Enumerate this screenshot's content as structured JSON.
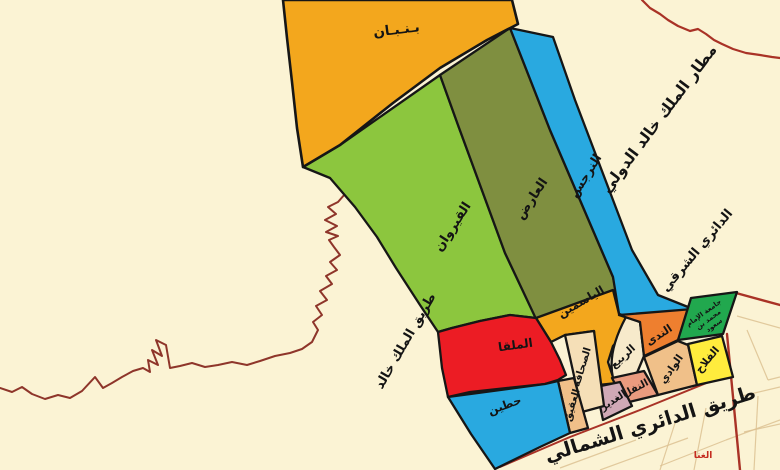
{
  "colors": {
    "background": "#FBF3D4",
    "orange": "#F3A71D",
    "light_green": "#8CC63E",
    "olive": "#7F8F40",
    "blue": "#29A9E0",
    "red": "#EC1C24",
    "cream": "#F5DFB7",
    "cream_light": "#F7EACB",
    "tan": "#F0C089",
    "mauve": "#D0A9B6",
    "salmon": "#EA9B7F",
    "orange_deep": "#EE7F2F",
    "yellow": "#FFEC3D",
    "green": "#21A84E",
    "road_red": "#A93226",
    "wadi_line": "#8E352A",
    "parcel": "#DCC192",
    "label": "#141414",
    "red_text": "#C42B1F"
  },
  "districts": {
    "banban": {
      "label": "بـنـبـان"
    },
    "qairawan": {
      "label": "القيروان"
    },
    "arid": {
      "label": "العارض"
    },
    "narjis": {
      "label": "النرجس"
    },
    "yasmin": {
      "label": "الياسمين"
    },
    "malqa": {
      "label": "الملقا"
    },
    "hittin": {
      "label": "حطين"
    },
    "sahafa": {
      "label": "الصحافة"
    },
    "rabi": {
      "label": "الربيع"
    },
    "aqiq": {
      "label": "العقيق"
    },
    "ghadir": {
      "label": "الغدير"
    },
    "nafal": {
      "label": "النفل"
    },
    "wadi": {
      "label": "الوادي"
    },
    "nada": {
      "label": "الندى"
    },
    "falah": {
      "label": "الفلاح"
    },
    "ghina": {
      "label": "الغنا"
    }
  },
  "landmarks": {
    "university": {
      "line1": "جامعة الإمام",
      "line2": "محمد بن",
      "line3": "سعود"
    },
    "airport": {
      "label": "مطار الملك خالد الدولي"
    }
  },
  "roads": {
    "east_ring": {
      "label": "الدائري الشرقي"
    },
    "king_khalid": {
      "label": "طريق الملك خالد"
    },
    "north_ring": {
      "label": "طريق الدائري الشمالي"
    }
  }
}
